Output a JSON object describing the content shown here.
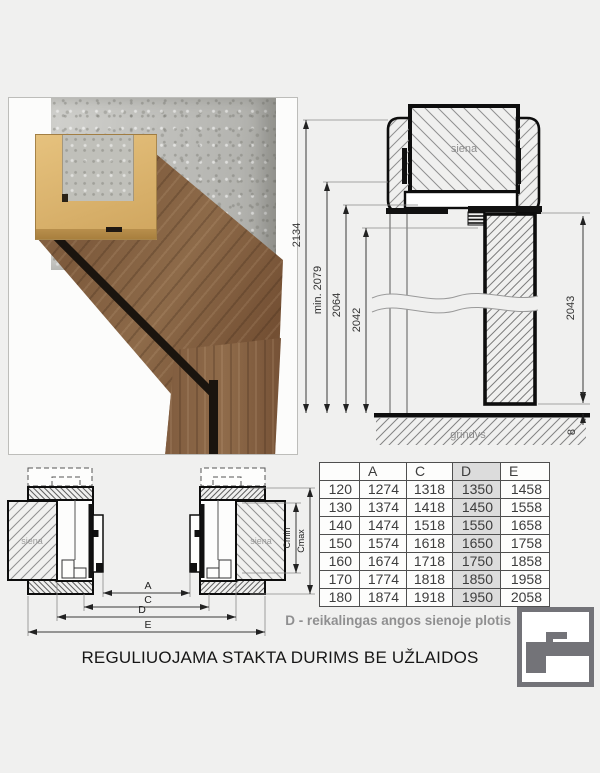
{
  "title": "REGULIUOJAMA STAKTA DURIMS BE UŽLAIDOS",
  "note": "D - reikalingas angos sienoje plotis",
  "vertical_section": {
    "wall_label": "siena",
    "floor_label": "grindys",
    "dim_total_height": "2134",
    "dim_min_height": "min. 2079",
    "dim_frame_height": "2064",
    "dim_opening_height": "2042",
    "dim_door_height": "2043",
    "dim_floor_gap": "8"
  },
  "horizontal_section": {
    "wall_label_left": "siena",
    "wall_label_right": "siena",
    "dim_a": "A",
    "dim_c": "C",
    "dim_d": "D",
    "dim_e": "E",
    "dim_cmin": "Cmin",
    "dim_cmax": "Cmax"
  },
  "table": {
    "headers": [
      "",
      "A",
      "C",
      "D",
      "E"
    ],
    "highlight_column": "D",
    "rows": [
      [
        "120",
        "1274",
        "1318",
        "1350",
        "1458"
      ],
      [
        "130",
        "1374",
        "1418",
        "1450",
        "1558"
      ],
      [
        "140",
        "1474",
        "1518",
        "1550",
        "1658"
      ],
      [
        "150",
        "1574",
        "1618",
        "1650",
        "1758"
      ],
      [
        "160",
        "1674",
        "1718",
        "1750",
        "1858"
      ],
      [
        "170",
        "1774",
        "1818",
        "1850",
        "1958"
      ],
      [
        "180",
        "1874",
        "1918",
        "1950",
        "2058"
      ]
    ]
  },
  "colors": {
    "background": "#f0f0ef",
    "table_highlight": "#dcdcdc",
    "logo_gray": "#737378",
    "annotation_gray": "#8f8f90"
  }
}
